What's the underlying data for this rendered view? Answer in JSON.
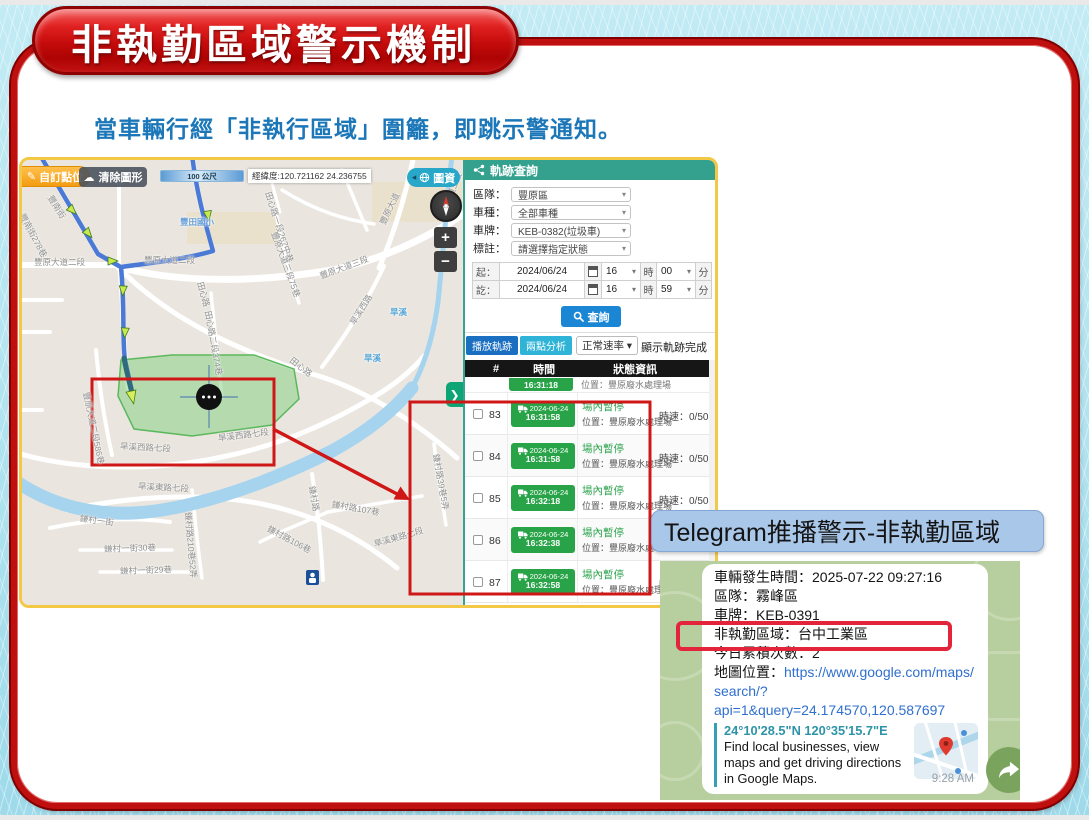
{
  "slide": {
    "title": "非執勤區域警示機制",
    "subtitle": "當車輛行經「非執行區域」圍籬，即跳示警通知。"
  },
  "colors": {
    "banner_red": "#c21111",
    "frame_red": "#bf0f0f",
    "screenshot_border_gold": "#f2c844",
    "panel_header_teal": "#34a18e",
    "badge_green": "#29a347",
    "query_blue": "#1b87d4",
    "alert_red": "#e3243b",
    "telegram_green": "#b7cf9e",
    "label_blue": "#a9c7e9"
  },
  "map": {
    "toolbar": {
      "custom_point": "自訂點位",
      "clear_shapes": "清除圖形",
      "scale": "100 公尺",
      "coords": "經緯度:120.721162 24.236755",
      "layers": "圖資"
    },
    "zoom_in": "+",
    "zoom_out": "−",
    "panel_toggle": "❯",
    "street_labels": [
      {
        "t": "豐南街",
        "x": 28,
        "y": 30,
        "r": 58
      },
      {
        "t": "豐南街278巷",
        "x": 0,
        "y": 48,
        "r": 62
      },
      {
        "t": "豐原大道二段",
        "x": 12,
        "y": 96,
        "r": 0
      },
      {
        "t": "豐原大道二段",
        "x": 122,
        "y": 94,
        "r": 0
      },
      {
        "t": "豐田國小",
        "x": 158,
        "y": 56,
        "r": 0,
        "c": "#69a0d9"
      },
      {
        "t": "田心路",
        "x": 178,
        "y": 116,
        "r": 74
      },
      {
        "t": "田心路二段374巷",
        "x": 186,
        "y": 145,
        "r": 80
      },
      {
        "t": "田心路一段267中巷",
        "x": 246,
        "y": 26,
        "r": 72
      },
      {
        "t": "豐原大道三段75巷",
        "x": 252,
        "y": 66,
        "r": 70
      },
      {
        "t": "豐原大道三段",
        "x": 298,
        "y": 110,
        "r": -20
      },
      {
        "t": "豐原大道",
        "x": 360,
        "y": 58,
        "r": -64
      },
      {
        "t": "豐原大道三段",
        "x": 418,
        "y": 54,
        "r": -68
      },
      {
        "t": "旱溪西路",
        "x": 330,
        "y": 158,
        "r": -58
      },
      {
        "t": "旱溪",
        "x": 368,
        "y": 146,
        "r": 0,
        "c": "#5aa7d6"
      },
      {
        "t": "旱溪",
        "x": 342,
        "y": 192,
        "r": 0,
        "c": "#5aa7d6"
      },
      {
        "t": "田心路",
        "x": 269,
        "y": 193,
        "r": 38
      },
      {
        "t": "豐原大道二段586巷",
        "x": 64,
        "y": 226,
        "r": 78
      },
      {
        "t": "旱溪西路七段",
        "x": 98,
        "y": 280,
        "r": 3
      },
      {
        "t": "旱溪西路七段",
        "x": 196,
        "y": 272,
        "r": -7
      },
      {
        "t": "旱溪東路七段",
        "x": 116,
        "y": 320,
        "r": 3
      },
      {
        "t": "旱溪東路七段",
        "x": 352,
        "y": 378,
        "r": -16
      },
      {
        "t": "鎌村一街",
        "x": 58,
        "y": 352,
        "r": 8
      },
      {
        "t": "鎌村一街30巷",
        "x": 82,
        "y": 383,
        "r": -2
      },
      {
        "t": "鎌村一街29巷",
        "x": 98,
        "y": 405,
        "r": -2
      },
      {
        "t": "鎌村路210巷52弄",
        "x": 166,
        "y": 346,
        "r": 85
      },
      {
        "t": "鎌村路106巷",
        "x": 246,
        "y": 362,
        "r": 28
      },
      {
        "t": "鎌村路107巷",
        "x": 310,
        "y": 338,
        "r": 10
      },
      {
        "t": "鎌村路",
        "x": 290,
        "y": 320,
        "r": 80
      },
      {
        "t": "鎌村路39巷5弄",
        "x": 414,
        "y": 288,
        "r": 80
      }
    ]
  },
  "query_panel": {
    "title": "軌跡查詢",
    "fields": [
      {
        "label": "區隊：",
        "value": "豐原區"
      },
      {
        "label": "車種：",
        "value": "全部車種"
      },
      {
        "label": "車牌：",
        "value": "KEB-0382(垃圾車)"
      },
      {
        "label": "標註：",
        "value": "請選擇指定狀態"
      }
    ],
    "time_rows": [
      {
        "label": "起：",
        "date": "2024/06/24",
        "hour": "16",
        "hour_unit": "時",
        "minute": "00",
        "minute_unit": "分"
      },
      {
        "label": "訖：",
        "date": "2024/06/24",
        "hour": "16",
        "hour_unit": "時",
        "minute": "59",
        "minute_unit": "分"
      }
    ],
    "search_button": "查詢",
    "toolbar": {
      "play_track": "播放軌跡",
      "two_point_analysis": "兩點分析",
      "speed_mode": "正常速率",
      "status_message": "顯示軌跡完成"
    },
    "table": {
      "headers": [
        "#",
        "時間",
        "狀態資訊"
      ],
      "partial_row": {
        "time": "16:31:18",
        "location": "位置：豐原廢水處理場"
      },
      "rows": [
        {
          "num": "83",
          "date": "2024-06-24",
          "time": "16:31:58",
          "status": "場內暫停",
          "location": "位置：豐原廢水處理場",
          "speed": "時速：0/50"
        },
        {
          "num": "84",
          "date": "2024-06-24",
          "time": "16:31:58",
          "status": "場內暫停",
          "location": "位置：豐原廢水處理場",
          "speed": "時速：0/50"
        },
        {
          "num": "85",
          "date": "2024-06-24",
          "time": "16:32:18",
          "status": "場內暫停",
          "location": "位置：豐原廢水處理場",
          "speed": "時速：0/50"
        },
        {
          "num": "86",
          "date": "2024-06-24",
          "time": "16:32:38",
          "status": "場內暫停",
          "location": "位置：豐原廢水處理場",
          "speed": "時速：0/50"
        },
        {
          "num": "87",
          "date": "2024-06-24",
          "time": "16:32:58",
          "status": "場內暫停",
          "location": "位置：豐原廢水處理場",
          "speed": "時速：0/50"
        }
      ]
    }
  },
  "telegram": {
    "label": "Telegram推播警示-非執勤區域",
    "message": {
      "line_time": "車輛發生時間：2025-07-22 09:27:16",
      "line_district": "區隊：霧峰區",
      "line_plate": "車牌：KEB-0391",
      "line_zone": "非執勤區域：台中工業區",
      "line_count": "今日累積次數：2",
      "map_label": "地圖位置：",
      "link_line1": "https://www.google.com/maps/",
      "link_line2": "search/?",
      "link_line3": "api=1&query=24.174570,120.587697",
      "preview_title": "24°10'28.5\"N 120°35'15.7\"E",
      "preview_desc": "Find local businesses, view maps and get driving directions in Google Maps.",
      "timestamp": "9:28 AM"
    }
  }
}
